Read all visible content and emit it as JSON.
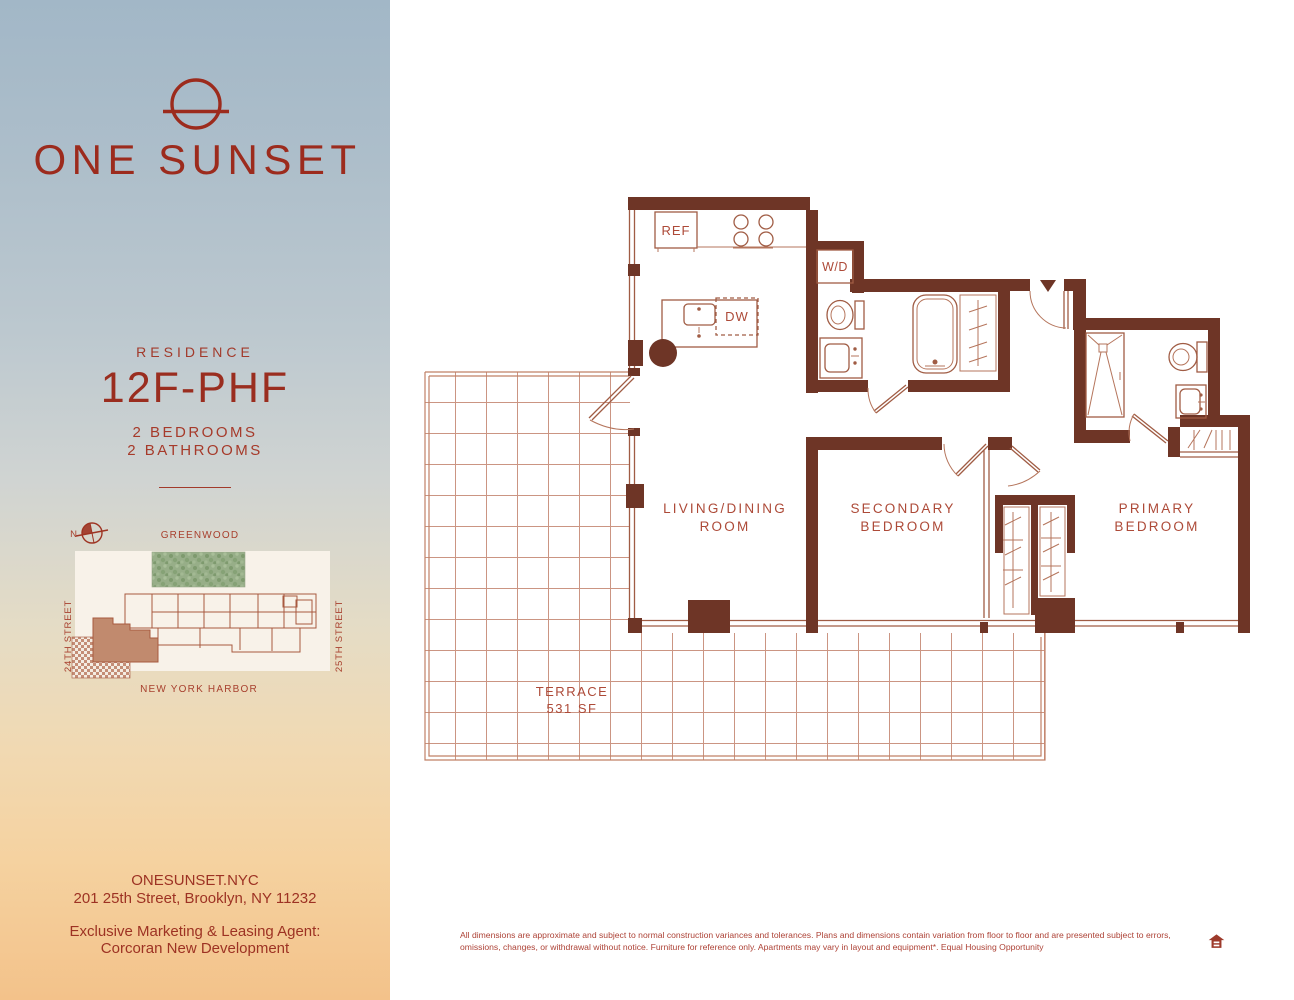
{
  "brand": {
    "name": "ONE SUNSET"
  },
  "residence": {
    "eyebrow": "RESIDENCE",
    "unit": "12F-PHF",
    "beds": "2 BEDROOMS",
    "baths": "2 BATHROOMS"
  },
  "sitemap": {
    "north": "N",
    "park": "GREENWOOD",
    "harbor": "NEW YORK HARBOR",
    "street_left": "24TH STREET",
    "street_right": "25TH STREET"
  },
  "contact": {
    "website": "ONESUNSET.NYC",
    "address": "201 25th Street, Brooklyn, NY 11232",
    "agent1": "Exclusive Marketing & Leasing Agent:",
    "agent2": "Corcoran New Development"
  },
  "plan": {
    "living1": "LIVING/DINING",
    "living2": "ROOM",
    "secondary1": "SECONDARY",
    "secondary2": "BEDROOM",
    "primary1": "PRIMARY",
    "primary2": "BEDROOM",
    "terrace1": "TERRACE",
    "terrace2": "531 SF",
    "ref": "REF",
    "wd": "W/D",
    "dw": "DW"
  },
  "disclaimer": {
    "line1": "All dimensions are approximate and subject to normal construction variances and tolerances. Plans and dimensions contain variation from floor to floor and are presented subject to errors,",
    "line2": "omissions, changes, or withdrawal without notice. Furniture for reference only.  Apartments may vary in layout and equipment*. Equal Housing Opportunity"
  },
  "colors": {
    "brand_red": "#9c2b1d",
    "wall": "#6e3526",
    "fixture_line": "#a05c44",
    "terrace_grid": "#cb9583",
    "label_red": "#ad4a38",
    "park_green": "#95ad86",
    "unit_highlight": "#c18a6e"
  }
}
